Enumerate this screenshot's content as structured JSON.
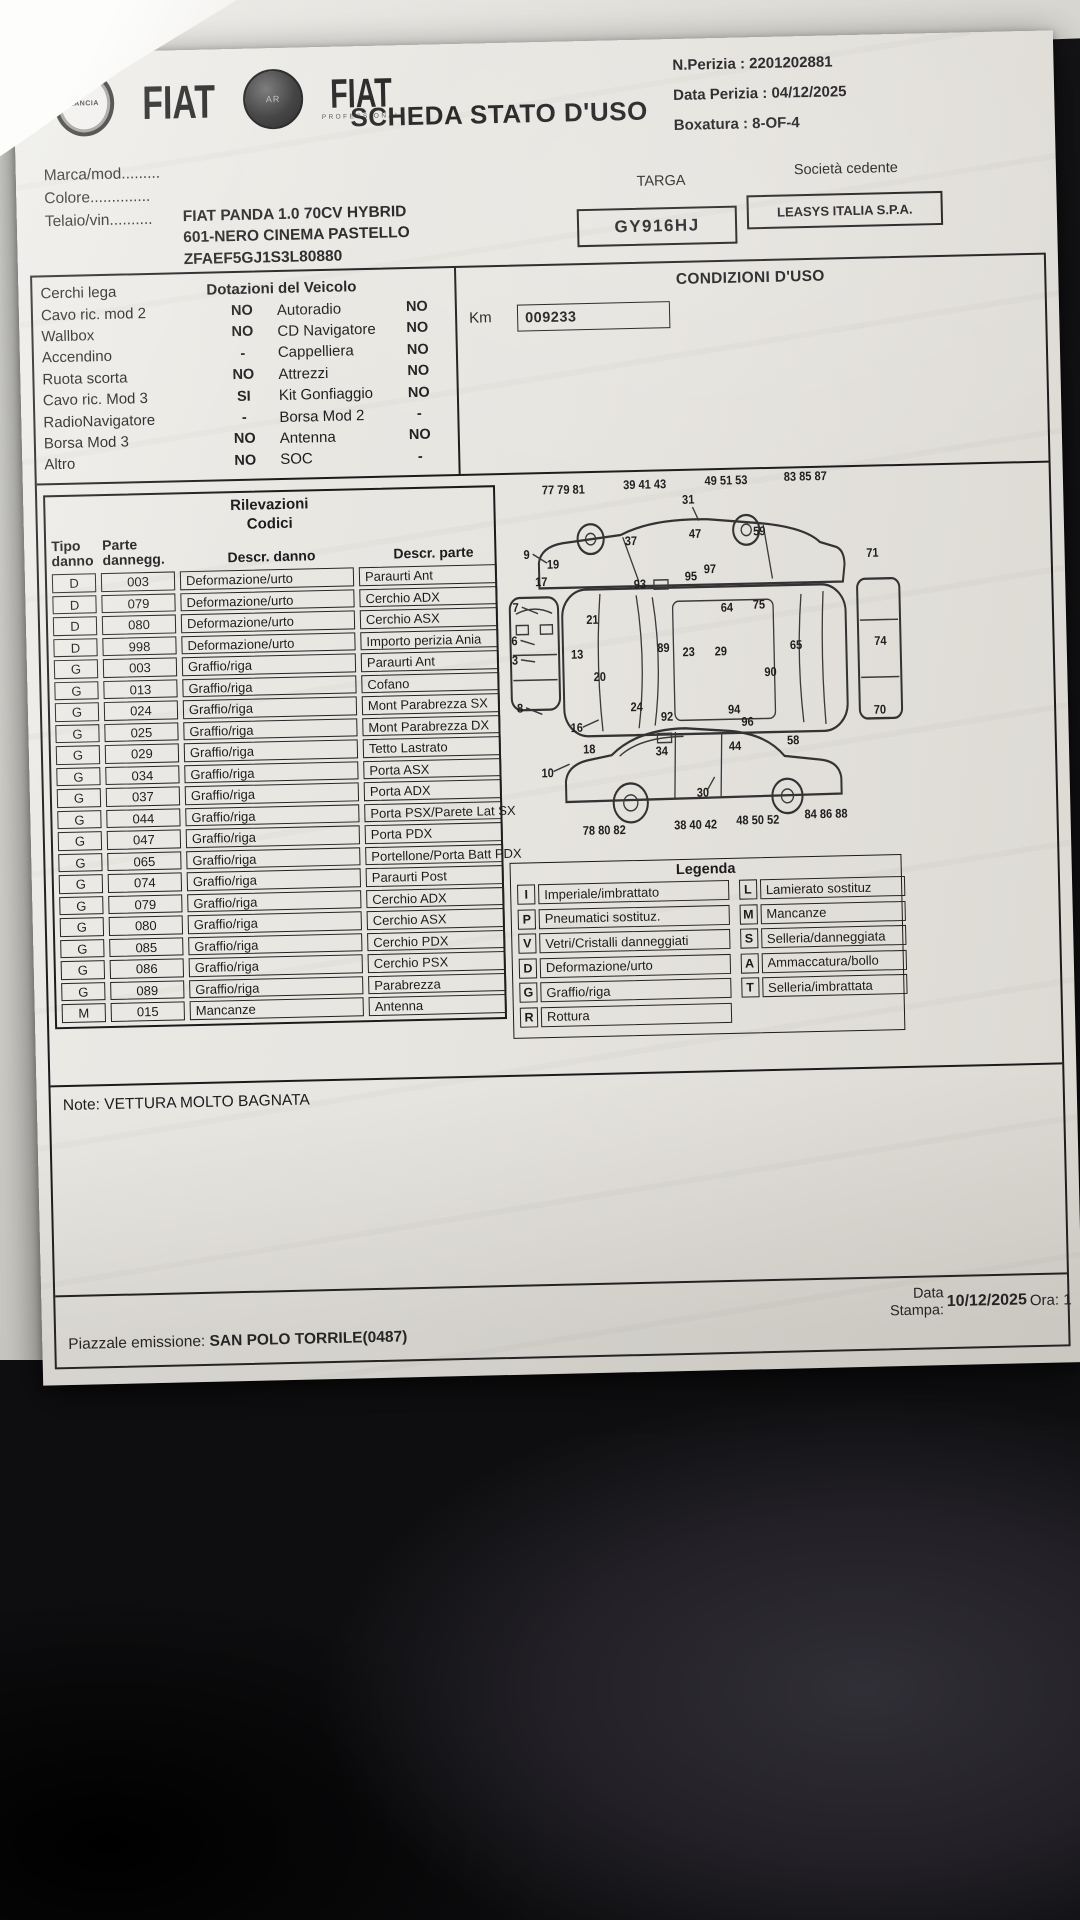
{
  "header": {
    "lancia": "LANCIA",
    "fiat": "FIAT",
    "alfa": "AR",
    "fiat2": "FIAT",
    "professional": "PROFESSIONAL",
    "title": "SCHEDA STATO D'USO",
    "n_perizia": "N.Perizia : 2201202881",
    "data_perizia": "Data Perizia : 04/12/2025",
    "boxatura": "Boxatura : 8-OF-4"
  },
  "vehicle": {
    "labels": [
      "Marca/mod.........",
      "Colore..............",
      "Telaio/vin.........."
    ],
    "values": [
      "FIAT PANDA 1.0 70CV HYBRID",
      "601-NERO CINEMA PASTELLO",
      "ZFAEF5GJ1S3L80880"
    ],
    "targa_label": "TARGA",
    "targa": "GY916HJ",
    "cedente_label": "Società cedente",
    "cedente": "LEASYS ITALIA S.P.A."
  },
  "dotazioni": {
    "rows": [
      {
        "l1": "Cerchi lega",
        "header": "Dotazioni del Veicolo"
      },
      {
        "l1": "Cavo ric. mod 2",
        "v1": "NO",
        "l2": "Autoradio",
        "v2": "NO"
      },
      {
        "l1": "Wallbox",
        "v1": "NO",
        "l2": "CD Navigatore",
        "v2": "NO"
      },
      {
        "l1": "Accendino",
        "v1": "-",
        "l2": "Cappelliera",
        "v2": "NO"
      },
      {
        "l1": "Ruota scorta",
        "v1": "NO",
        "l2": "Attrezzi",
        "v2": "NO"
      },
      {
        "l1": "Cavo ric. Mod 3",
        "v1": "SI",
        "l2": "Kit Gonfiaggio",
        "v2": "NO"
      },
      {
        "l1": "RadioNavigatore",
        "v1": "-",
        "l2": "Borsa Mod 2",
        "v2": "-"
      },
      {
        "l1": "Borsa Mod 3",
        "v1": "NO",
        "l2": "Antenna",
        "v2": "NO"
      },
      {
        "l1": "Altro",
        "v1": "NO",
        "l2": "SOC",
        "v2": "-"
      }
    ]
  },
  "condizioni": {
    "title": "CONDIZIONI D'USO",
    "km_label": "Km",
    "km_value": "009233"
  },
  "rilevazioni": {
    "title1": "Rilevazioni",
    "title2": "Codici",
    "col1a": "Tipo",
    "col1b": "danno",
    "col2a": "Parte",
    "col2b": "dannegg.",
    "col3": "Descr. danno",
    "col4": "Descr. parte",
    "rows": [
      [
        "D",
        "003",
        "Deformazione/urto",
        "Paraurti Ant"
      ],
      [
        "D",
        "079",
        "Deformazione/urto",
        "Cerchio ADX"
      ],
      [
        "D",
        "080",
        "Deformazione/urto",
        "Cerchio ASX"
      ],
      [
        "D",
        "998",
        "Deformazione/urto",
        "Importo perizia Ania"
      ],
      [
        "G",
        "003",
        "Graffio/riga",
        "Paraurti Ant"
      ],
      [
        "G",
        "013",
        "Graffio/riga",
        "Cofano"
      ],
      [
        "G",
        "024",
        "Graffio/riga",
        "Mont Parabrezza SX"
      ],
      [
        "G",
        "025",
        "Graffio/riga",
        "Mont Parabrezza DX"
      ],
      [
        "G",
        "029",
        "Graffio/riga",
        "Tetto Lastrato"
      ],
      [
        "G",
        "034",
        "Graffio/riga",
        "Porta ASX"
      ],
      [
        "G",
        "037",
        "Graffio/riga",
        "Porta ADX"
      ],
      [
        "G",
        "044",
        "Graffio/riga",
        "Porta PSX/Parete Lat SX"
      ],
      [
        "G",
        "047",
        "Graffio/riga",
        "Porta PDX"
      ],
      [
        "G",
        "065",
        "Graffio/riga",
        "Portellone/Porta Batt PDX"
      ],
      [
        "G",
        "074",
        "Graffio/riga",
        "Paraurti Post"
      ],
      [
        "G",
        "079",
        "Graffio/riga",
        "Cerchio ADX"
      ],
      [
        "G",
        "080",
        "Graffio/riga",
        "Cerchio ASX"
      ],
      [
        "G",
        "085",
        "Graffio/riga",
        "Cerchio PDX"
      ],
      [
        "G",
        "086",
        "Graffio/riga",
        "Cerchio PSX"
      ],
      [
        "G",
        "089",
        "Graffio/riga",
        "Parabrezza"
      ],
      [
        "M",
        "015",
        "Mancanze",
        "Antenna"
      ]
    ]
  },
  "diagram": {
    "numbers": [
      {
        "t": "77 79 81",
        "x": 62,
        "y": 16
      },
      {
        "t": "39 41 43",
        "x": 143,
        "y": 13
      },
      {
        "t": "31",
        "x": 186,
        "y": 27
      },
      {
        "t": "49 51 53",
        "x": 224,
        "y": 11
      },
      {
        "t": "83 85 87",
        "x": 303,
        "y": 9
      },
      {
        "t": "9",
        "x": 24,
        "y": 72
      },
      {
        "t": "19",
        "x": 50,
        "y": 81
      },
      {
        "t": "17",
        "x": 38,
        "y": 96
      },
      {
        "t": "37",
        "x": 128,
        "y": 62
      },
      {
        "t": "47",
        "x": 192,
        "y": 57
      },
      {
        "t": "59",
        "x": 256,
        "y": 56
      },
      {
        "t": "93",
        "x": 136,
        "y": 100
      },
      {
        "t": "95",
        "x": 187,
        "y": 94
      },
      {
        "t": "97",
        "x": 206,
        "y": 88
      },
      {
        "t": "71",
        "x": 368,
        "y": 77
      },
      {
        "t": "7",
        "x": 12,
        "y": 118
      },
      {
        "t": "21",
        "x": 88,
        "y": 130
      },
      {
        "t": "64",
        "x": 222,
        "y": 122
      },
      {
        "t": "75",
        "x": 254,
        "y": 120
      },
      {
        "t": "6",
        "x": 10,
        "y": 147
      },
      {
        "t": "13",
        "x": 72,
        "y": 160
      },
      {
        "t": "89",
        "x": 158,
        "y": 156
      },
      {
        "t": "23",
        "x": 183,
        "y": 160
      },
      {
        "t": "29",
        "x": 215,
        "y": 160
      },
      {
        "t": "65",
        "x": 290,
        "y": 156
      },
      {
        "t": "74",
        "x": 374,
        "y": 154
      },
      {
        "t": "3",
        "x": 10,
        "y": 164
      },
      {
        "t": "20",
        "x": 94,
        "y": 180
      },
      {
        "t": "90",
        "x": 264,
        "y": 179
      },
      {
        "t": "8",
        "x": 14,
        "y": 206
      },
      {
        "t": "24",
        "x": 130,
        "y": 207
      },
      {
        "t": "92",
        "x": 160,
        "y": 216
      },
      {
        "t": "94",
        "x": 227,
        "y": 211
      },
      {
        "t": "96",
        "x": 240,
        "y": 222
      },
      {
        "t": "70",
        "x": 372,
        "y": 214
      },
      {
        "t": "16",
        "x": 70,
        "y": 224
      },
      {
        "t": "18",
        "x": 82,
        "y": 243
      },
      {
        "t": "34",
        "x": 154,
        "y": 246
      },
      {
        "t": "44",
        "x": 227,
        "y": 243
      },
      {
        "t": "58",
        "x": 285,
        "y": 239
      },
      {
        "t": "10",
        "x": 40,
        "y": 263
      },
      {
        "t": "30",
        "x": 194,
        "y": 283
      },
      {
        "t": "78 80 82",
        "x": 95,
        "y": 314
      },
      {
        "t": "38 40 42",
        "x": 186,
        "y": 311
      },
      {
        "t": "48 50 52",
        "x": 248,
        "y": 308
      },
      {
        "t": "84 86 88",
        "x": 316,
        "y": 304
      }
    ]
  },
  "legend": {
    "title": "Legenda",
    "left": [
      [
        "I",
        "Imperiale/imbrattato"
      ],
      [
        "P",
        "Pneumatici sostituz."
      ],
      [
        "V",
        "Vetri/Cristalli danneggiati"
      ],
      [
        "D",
        "Deformazione/urto"
      ],
      [
        "G",
        "Graffio/riga"
      ],
      [
        "R",
        "Rottura"
      ]
    ],
    "right": [
      [
        "L",
        "Lamierato sostituz"
      ],
      [
        "M",
        "Mancanze"
      ],
      [
        "S",
        "Selleria/danneggiata"
      ],
      [
        "A",
        "Ammaccatura/bollo"
      ],
      [
        "T",
        "Selleria/imbrattata"
      ]
    ]
  },
  "note": {
    "label": "Note:",
    "text": "VETTURA MOLTO BAGNATA"
  },
  "footer": {
    "piazzale_label": "Piazzale emissione:",
    "piazzale_value": "SAN POLO TORRILE(0487)",
    "data_label_1": "Data",
    "data_label_2": "Stampa:",
    "data_value": "10/12/2025",
    "ora": "Ora: 1"
  }
}
